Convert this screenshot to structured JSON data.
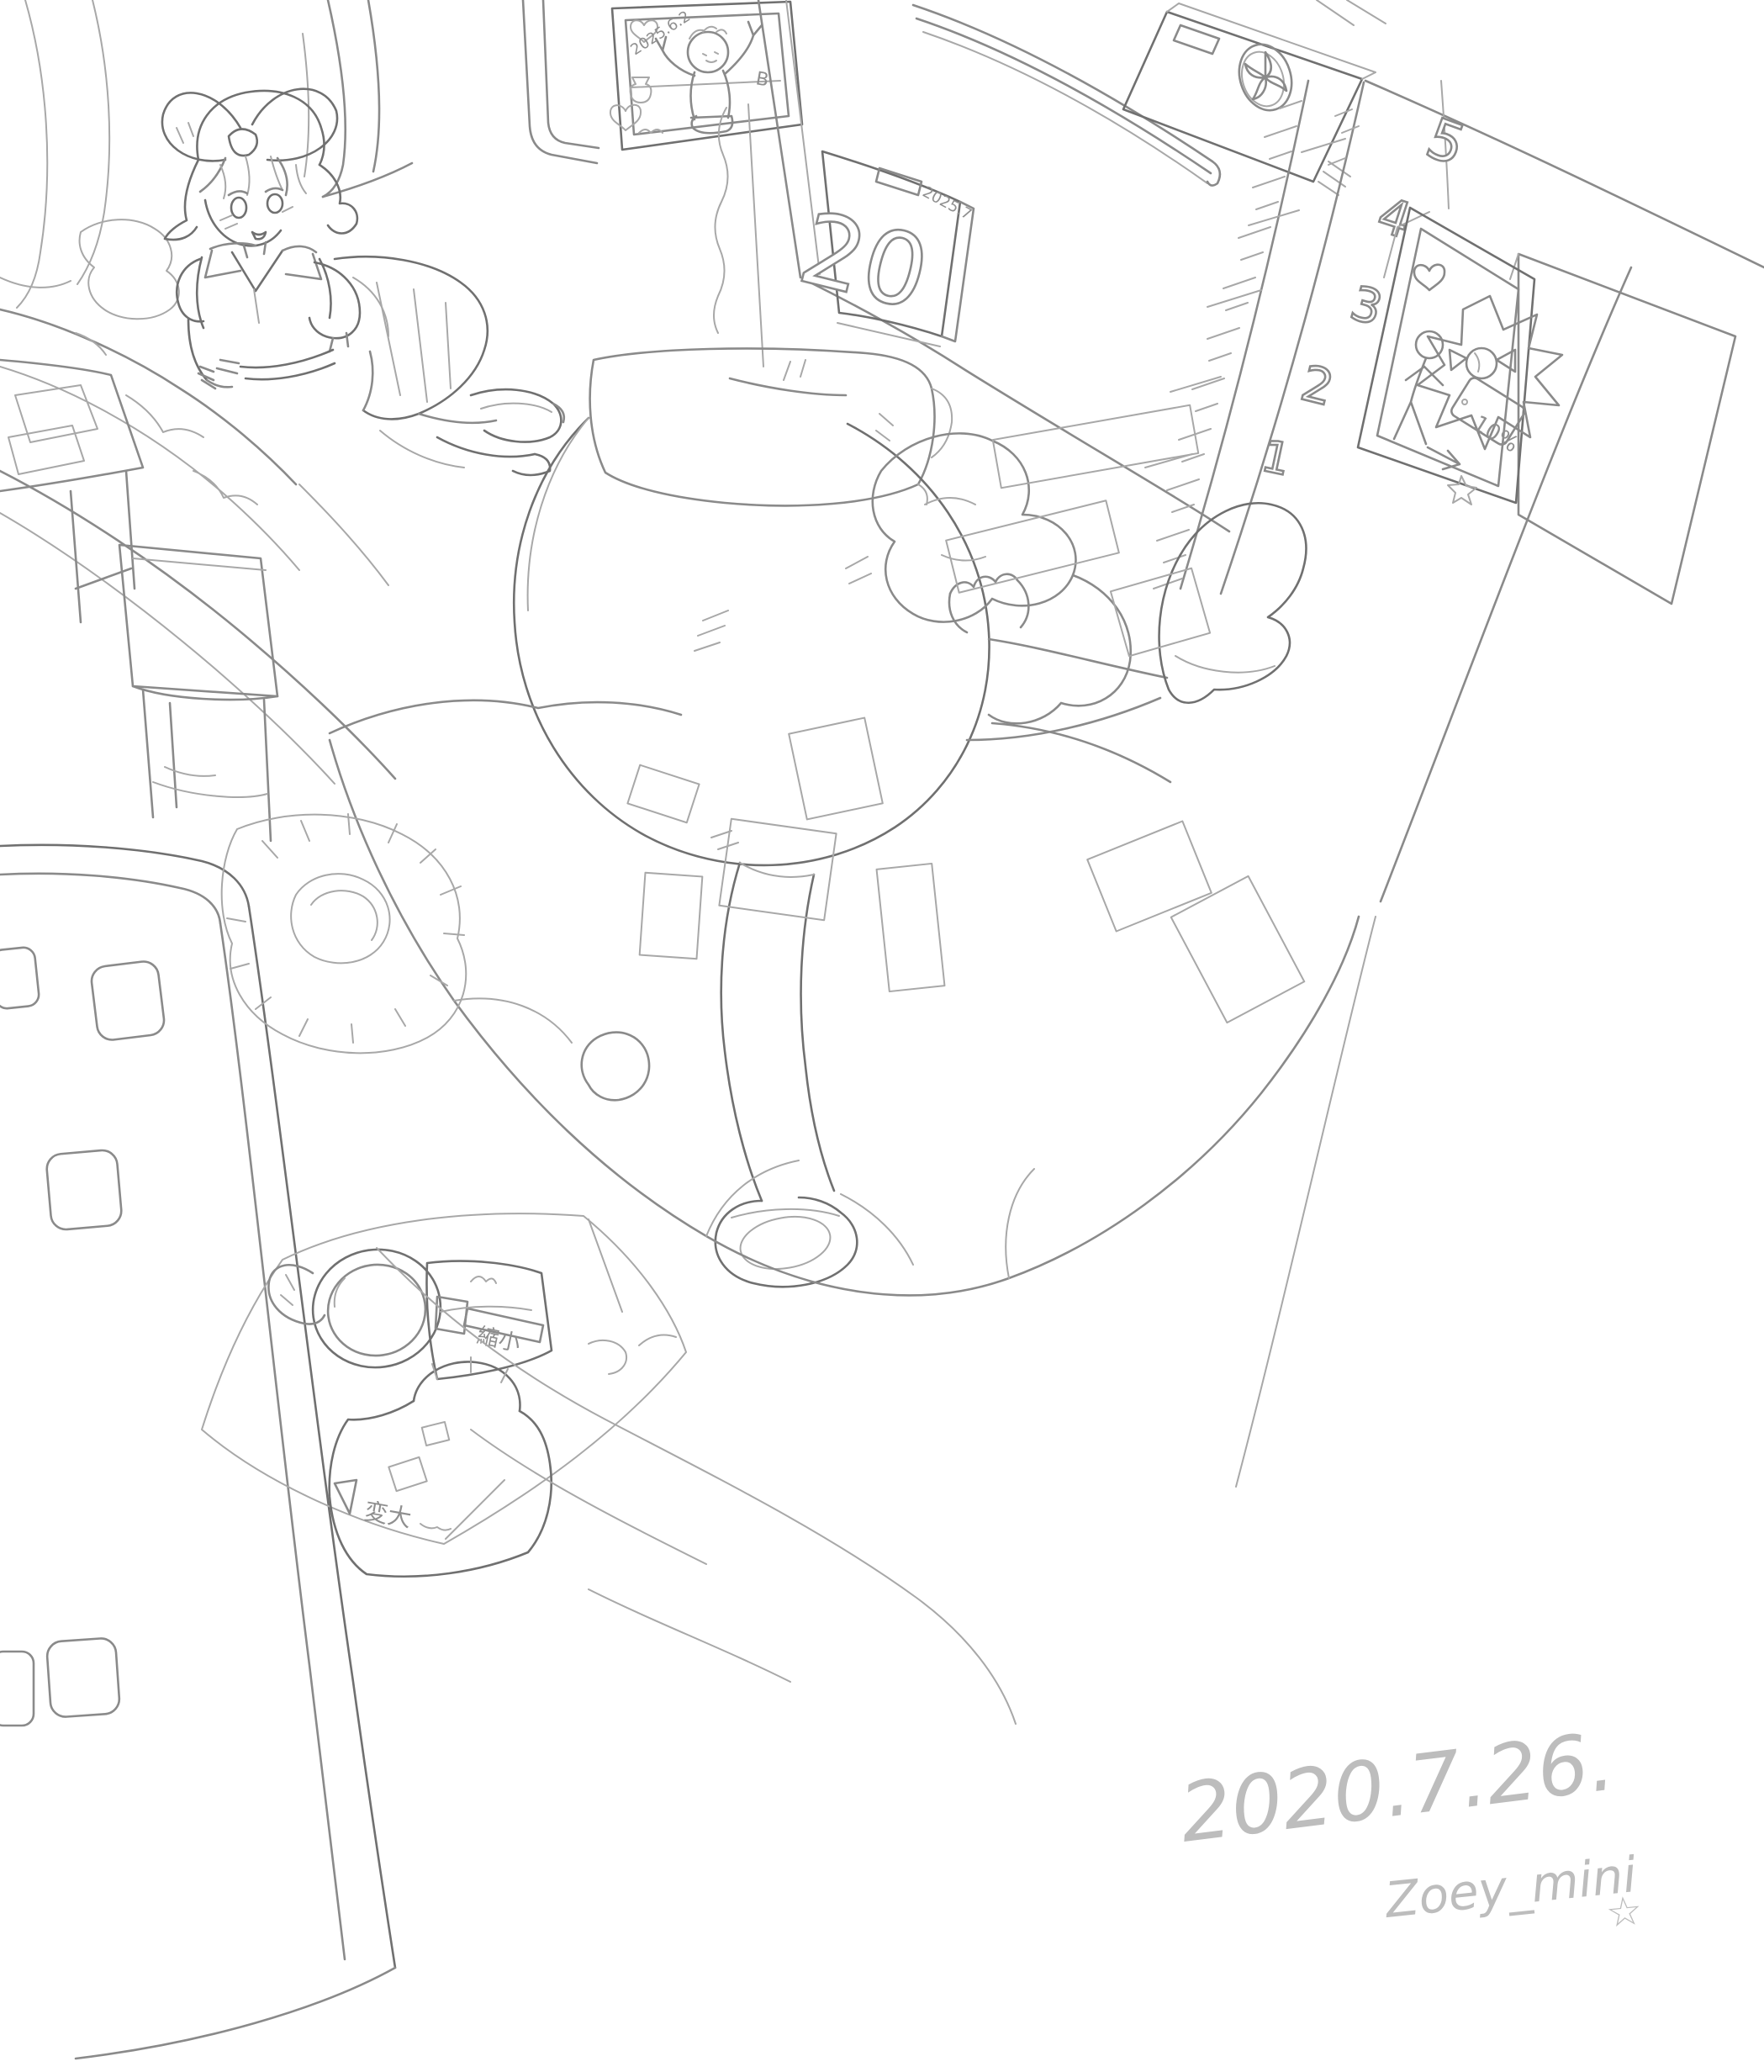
{
  "colors": {
    "background": "#ffffff",
    "pencil_line": "#8a8a8a",
    "pencil_dark": "#707070",
    "pencil_light": "#a8a8a8",
    "signature_gray": "#bdbdbd"
  },
  "wall_poster": {
    "date_label": "2025.6.2",
    "letter_label": "B"
  },
  "calendar": {
    "day": "20",
    "period_label": "2025.7"
  },
  "height_chart": {
    "marks": [
      "5",
      "4",
      "3",
      "2",
      "1"
    ]
  },
  "framed_drawing": {
    "tag_label": "10%"
  },
  "snack_bags": {
    "shrink_bag_label": "縮小",
    "grow_bag_label": "変大"
  },
  "signature": {
    "date": "2020.7.26.",
    "artist": "Zoey_mini",
    "star": "☆"
  }
}
